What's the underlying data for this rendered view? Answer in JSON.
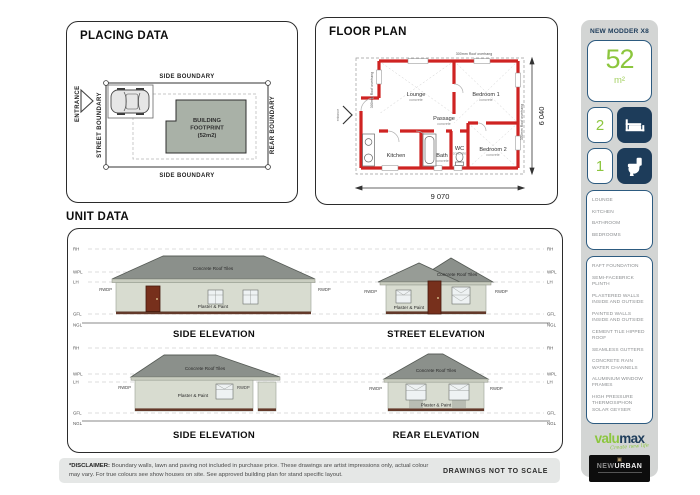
{
  "placing": {
    "title": "PLACING DATA",
    "entrance": "ENTRANCE",
    "side_boundary": "SIDE BOUNDARY",
    "street_boundary": "STREET BOUNDARY",
    "rear_boundary": "REAR BOUNDARY",
    "footprint_line1": "BUILDING",
    "footprint_line2": "FOOTPRINT",
    "footprint_line3": "(52m2)"
  },
  "floorplan": {
    "title": "FLOOR PLAN",
    "rooms": {
      "lounge": "Lounge",
      "bedroom1": "Bedroom 1",
      "bedroom2": "Bedroom 2",
      "passage": "Passage",
      "kitchen": "Kitchen",
      "bath": "Bath",
      "wc": "WC",
      "finish": "concrete"
    },
    "dim_width": "9 070",
    "dim_height": "6 040",
    "overhang_note": "300mm Roof overhang",
    "entrance": "entrance"
  },
  "unit_data": {
    "title": "UNIT DATA",
    "levels": [
      "RH",
      "WPL",
      "LH",
      "GFL",
      "NGL"
    ],
    "rwdp": "RWDP",
    "roof_label": "Concrete Roof Tiles",
    "wall_label": "Plaster & Paint",
    "elevations": [
      "SIDE ELEVATION",
      "STREET ELEVATION",
      "SIDE ELEVATION",
      "REAR ELEVATION"
    ]
  },
  "sidebar": {
    "model": "NEW MODDER X8",
    "area_value": "52",
    "area_unit": "m²",
    "bedrooms": "2",
    "bathrooms": "1",
    "rooms": [
      "LOUNGE",
      "KITCHEN",
      "BATHROOM",
      "BEDROOMS"
    ],
    "features": [
      "RAFT FOUNDATION",
      "SEMI-FACEBRICK PLINTH",
      "PLASTERED WALLS INSIDE AND OUTSIDE",
      "PAINTED WALLS INSIDE AND OUTSIDE",
      "CEMENT TILE HIPPED ROOF",
      "SEAMLESS GUTTERS",
      "CONCRETE RAIN WATER CHANNELS",
      "ALUMINIUM WINDOW FRAMES",
      "HIGH PRESSURE THERMOSIPHON SOLAR GEYSER"
    ],
    "brand": {
      "valu": "valu",
      "max": "max",
      "tagline": "Create new life",
      "nu_new": "NEW",
      "nu_urban": "URBAN",
      "nu_emblem": "▣"
    }
  },
  "footer": {
    "disclaimer_label": "*DISCLAIMER:",
    "disclaimer_text": "Boundary walls, lawn and paving not included in purchase price. These drawings are artist impressions only, actual colour may vary. For true colours see show houses on site. See approved building plan for stand specific layout.",
    "scale_note": "DRAWINGS NOT TO SCALE"
  },
  "colors": {
    "accent_green": "#8cc63e",
    "navy": "#1d3c5a",
    "wall_red": "#cf2322",
    "sidebar_gray": "#d3d5d4",
    "roof_gray": "#8b908b"
  }
}
